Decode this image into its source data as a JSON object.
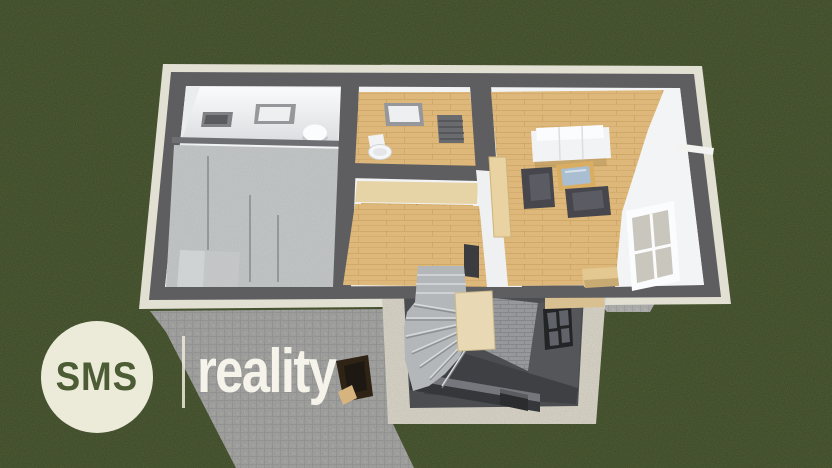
{
  "logo": {
    "brand": "SMS",
    "suffix": "reality"
  },
  "colors": {
    "grass": "#4e5d33",
    "pavement": "#a9a9a7",
    "pavement_line": "#96969a",
    "foundation": "#e2dfd3",
    "curb": "#dcd8cb",
    "wall": "#5e5e61",
    "interior": "#f2f3f4",
    "concrete": "#c6c9c9",
    "wood": "#ddb87a",
    "wood_seam": "#c49a58",
    "panel_wood": "#d5ad69",
    "sofa": "#f2f3f5",
    "chair": "#46464c",
    "chair_cushion": "#5b5b63",
    "table_wood": "#d9ae62",
    "glass": "#a9bed1",
    "window_frame": "#fbfcfd",
    "window_pane": "#c9c6be",
    "pit_wall": "#54565a",
    "pit_dark": "#4b4d51",
    "pit_floor": "#3e4044",
    "brick": "#96989b",
    "brick_line": "#85878b",
    "stair": "#b4b7ba",
    "stair_edge": "#d8dadc",
    "plywood": "#e8d9b4",
    "beam_wood": "#d9c090",
    "fixture_white": "#fbfcfd",
    "vent": "#808184",
    "radiator": "#6a6b6e",
    "object_brown": "#2e2315",
    "object_tan": "#d7b47d",
    "logo_circle": "#ecead9",
    "logo_green": "#4c5c35",
    "logo_white": "#f5f3ea"
  }
}
